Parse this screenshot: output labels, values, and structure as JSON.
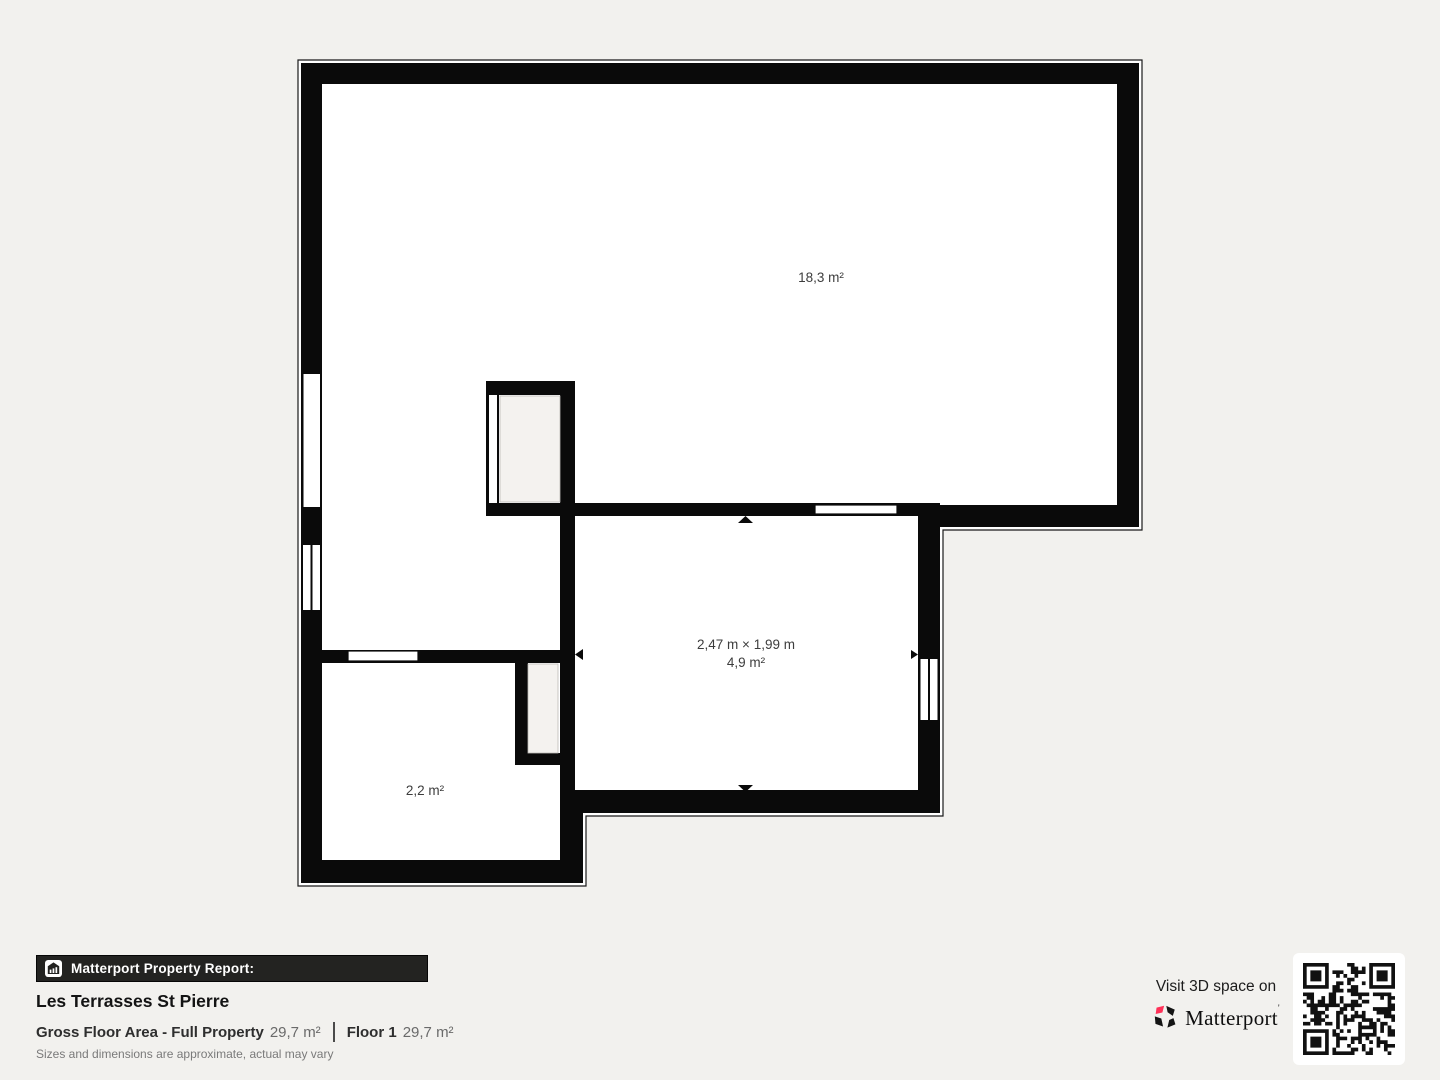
{
  "colors": {
    "background": "#f2f1ee",
    "wall": "#0a0a0a",
    "room_fill": "#ffffff",
    "shaft_fill": "#f4f2ef",
    "accent_red": "#ff3158",
    "bar_background": "#232321",
    "text_primary": "#141414",
    "text_secondary": "#6a6a6a"
  },
  "icons": {
    "report_icon": "house-with-chart-bars",
    "brand_icon": "matterport-pinwheel-mark",
    "qr_icon": "qr-code",
    "door_markers": [
      "arrow-up",
      "arrow-down",
      "arrow-left",
      "arrow-right"
    ]
  },
  "floorplan": {
    "rooms": [
      {
        "name": "large-room",
        "area_label": "18,3 m²"
      },
      {
        "name": "middle-room",
        "dimensions_label": "2,47 m × 1,99 m",
        "area_label": "4,9 m²"
      },
      {
        "name": "small-room",
        "area_label": "2,2 m²"
      }
    ]
  },
  "footer": {
    "report_bar_label": "Matterport Property Report:",
    "property_name": "Les Terrasses St Pierre",
    "gross_floor_area_label": "Gross Floor Area - Full Property",
    "gross_floor_area_value": "29,7 m²",
    "floor_label": "Floor 1",
    "floor_value": "29,7 m²",
    "disclaimer": "Sizes and dimensions are approximate, actual may vary"
  },
  "cta": {
    "visit_label": "Visit 3D space on",
    "brand_name": "Matterport",
    "trademark_mark": "'"
  }
}
